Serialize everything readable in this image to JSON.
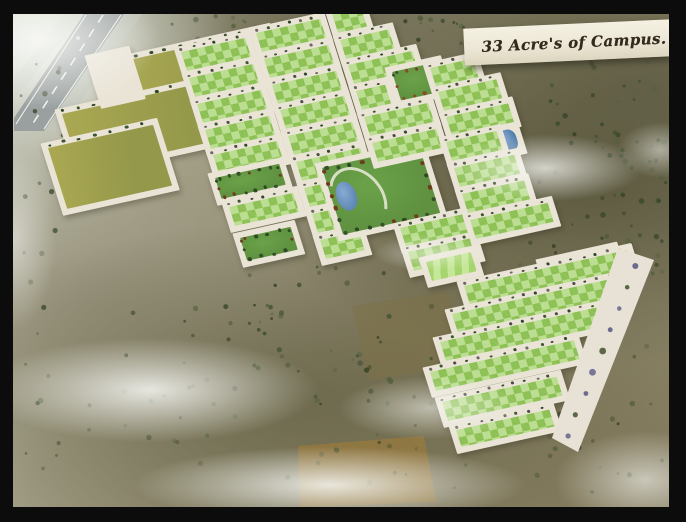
{
  "banner": {
    "label": "33 Acre's of Campus."
  },
  "palette": {
    "frame": "#0c0c0c",
    "road": "#eae4d6",
    "highway": "#9aa0a0",
    "plot_light": "#bcde92",
    "plot_dark": "#8dc155",
    "field_olive_1": "#aaa852",
    "field_olive_2": "#94984a",
    "park_lawn": "#5f9140",
    "lawn_stripe_1": "#a6d46e",
    "lawn_stripe_2": "#c6e798",
    "pond_blue": "#4d79a8",
    "tree_dark": "#3c4a2c",
    "tree_purple": "#63618a",
    "terrain_brown": "#97793f"
  },
  "scene": {
    "blocks": [
      [
        "field-top",
        "field",
        120,
        62,
        150,
        46
      ],
      [
        "field-main",
        "field",
        62,
        114,
        172,
        60
      ],
      [
        "field-low",
        "field",
        48,
        148,
        108,
        64
      ],
      [
        "entrance-plaza",
        "plaza",
        92,
        60,
        34,
        44
      ],
      [
        "west-plaza",
        "plaza",
        196,
        64,
        28,
        48
      ],
      [
        "plot-a1",
        "plot",
        181,
        52,
        66,
        20
      ],
      [
        "plot-a2",
        "plot",
        189,
        78,
        66,
        20
      ],
      [
        "plot-a3",
        "plot",
        197,
        104,
        66,
        20
      ],
      [
        "plot-a4",
        "plot",
        205,
        130,
        66,
        20
      ],
      [
        "plot-a5",
        "plot",
        213,
        155,
        66,
        20
      ],
      [
        "park-west",
        "park",
        215,
        178,
        66,
        22
      ],
      [
        "plot-a6",
        "plot",
        229,
        207,
        66,
        20
      ],
      [
        "park-south",
        "park",
        240,
        238,
        52,
        24
      ],
      [
        "plot-b1",
        "plot",
        256,
        33,
        66,
        20
      ],
      [
        "plot-b2",
        "plot",
        264,
        59,
        66,
        20
      ],
      [
        "plot-b3",
        "plot",
        272,
        85,
        66,
        20
      ],
      [
        "plot-b4",
        "plot",
        280,
        110,
        66,
        20
      ],
      [
        "plot-b5",
        "plot",
        288,
        136,
        66,
        20
      ],
      [
        "plot-b6",
        "plot",
        296,
        162,
        66,
        20
      ],
      [
        "plot-b7",
        "plot",
        304,
        188,
        40,
        20
      ],
      [
        "plot-b8",
        "plot",
        312,
        214,
        40,
        20
      ],
      [
        "plot-b9",
        "plot",
        320,
        240,
        40,
        20
      ],
      [
        "central-park",
        "cpark",
        322,
        168,
        100,
        70
      ],
      [
        "plot-c1",
        "plot",
        332,
        14,
        30,
        20
      ],
      [
        "plot-c2",
        "plot",
        340,
        40,
        50,
        20
      ],
      [
        "plot-c3",
        "plot",
        348,
        65,
        66,
        20
      ],
      [
        "plot-c4",
        "plot",
        356,
        91,
        30,
        20
      ],
      [
        "park-red",
        "parkred",
        392,
        72,
        46,
        30
      ],
      [
        "plot-c5",
        "plot",
        364,
        117,
        66,
        20
      ],
      [
        "plot-c6",
        "plot",
        372,
        143,
        66,
        20
      ],
      [
        "plot-c7",
        "plot",
        400,
        228,
        66,
        20
      ],
      [
        "plot-c8",
        "plot",
        408,
        252,
        66,
        20
      ],
      [
        "plot-d1",
        "plot",
        430,
        68,
        44,
        20
      ],
      [
        "plot-d2",
        "plot",
        438,
        92,
        60,
        20
      ],
      [
        "plot-d3",
        "plot",
        446,
        117,
        64,
        20
      ],
      [
        "pond-east",
        "pond",
        496,
        132,
        18,
        22
      ],
      [
        "plot-d4",
        "plot",
        446,
        142,
        52,
        20
      ],
      [
        "plot-d5",
        "plot",
        454,
        168,
        62,
        20
      ],
      [
        "plot-d6",
        "plot",
        462,
        194,
        64,
        20
      ],
      [
        "plot-d7",
        "plot",
        470,
        220,
        80,
        20
      ],
      [
        "lawn-west",
        "lawn",
        426,
        262,
        46,
        20
      ],
      [
        "lawn-east",
        "lawn",
        543,
        264,
        72,
        34
      ],
      [
        "plot-e1",
        "plot",
        464,
        286,
        168,
        20
      ],
      [
        "plot-e2",
        "plot",
        452,
        314,
        170,
        20
      ],
      [
        "plot-e3",
        "plot",
        440,
        342,
        164,
        20
      ],
      [
        "plot-e4",
        "plot",
        430,
        372,
        148,
        20
      ],
      [
        "plot-e5",
        "plot",
        442,
        402,
        118,
        20
      ],
      [
        "plot-e6",
        "plot",
        456,
        430,
        96,
        18
      ]
    ],
    "patches": [
      {
        "name": "farm-field-south",
        "points": "298,446 424,436 436,502 300,507",
        "fill": "#96793f",
        "opacity": 0.8
      },
      {
        "name": "farm-field-mid",
        "points": "352,306 448,292 466,366 368,380",
        "fill": "#7e6f45",
        "opacity": 0.5
      }
    ],
    "highway": {
      "body": "84,14 124,14 44,131 14,131 14,118",
      "shoulder_east": "124,14 142,14 60,131 44,131",
      "shoulder_west": "64,14 84,14 14,100 14,78",
      "edges": [
        [
          86,
          15,
          16,
          124
        ],
        [
          121,
          15,
          44,
          129
        ]
      ],
      "dash": [
        103,
        15,
        30,
        128
      ]
    },
    "east_road": {
      "points": "618,248 654,260 578,452 552,438",
      "trees_from": [
        634,
        266
      ],
      "trees_to": [
        566,
        436
      ],
      "tree_count": 9
    },
    "mist": [
      [
        40,
        40,
        170,
        100,
        0.9
      ],
      [
        545,
        168,
        140,
        48,
        0.75
      ],
      [
        430,
        253,
        80,
        26,
        0.5
      ],
      [
        150,
        390,
        240,
        75,
        0.85
      ],
      [
        430,
        408,
        130,
        45,
        0.55
      ],
      [
        330,
        485,
        280,
        55,
        0.85
      ],
      [
        645,
        480,
        130,
        70,
        0.6
      ],
      [
        14,
        240,
        60,
        130,
        0.5
      ],
      [
        660,
        150,
        60,
        40,
        0.5
      ]
    ],
    "tree_regions": [
      [
        152,
        16,
        316,
        34,
        34
      ],
      [
        470,
        56,
        196,
        236,
        76
      ],
      [
        16,
        60,
        68,
        248,
        20
      ],
      [
        238,
        254,
        186,
        118,
        24
      ],
      [
        20,
        302,
        644,
        192,
        118
      ],
      [
        598,
        64,
        66,
        236,
        28
      ]
    ],
    "seed": 11
  }
}
